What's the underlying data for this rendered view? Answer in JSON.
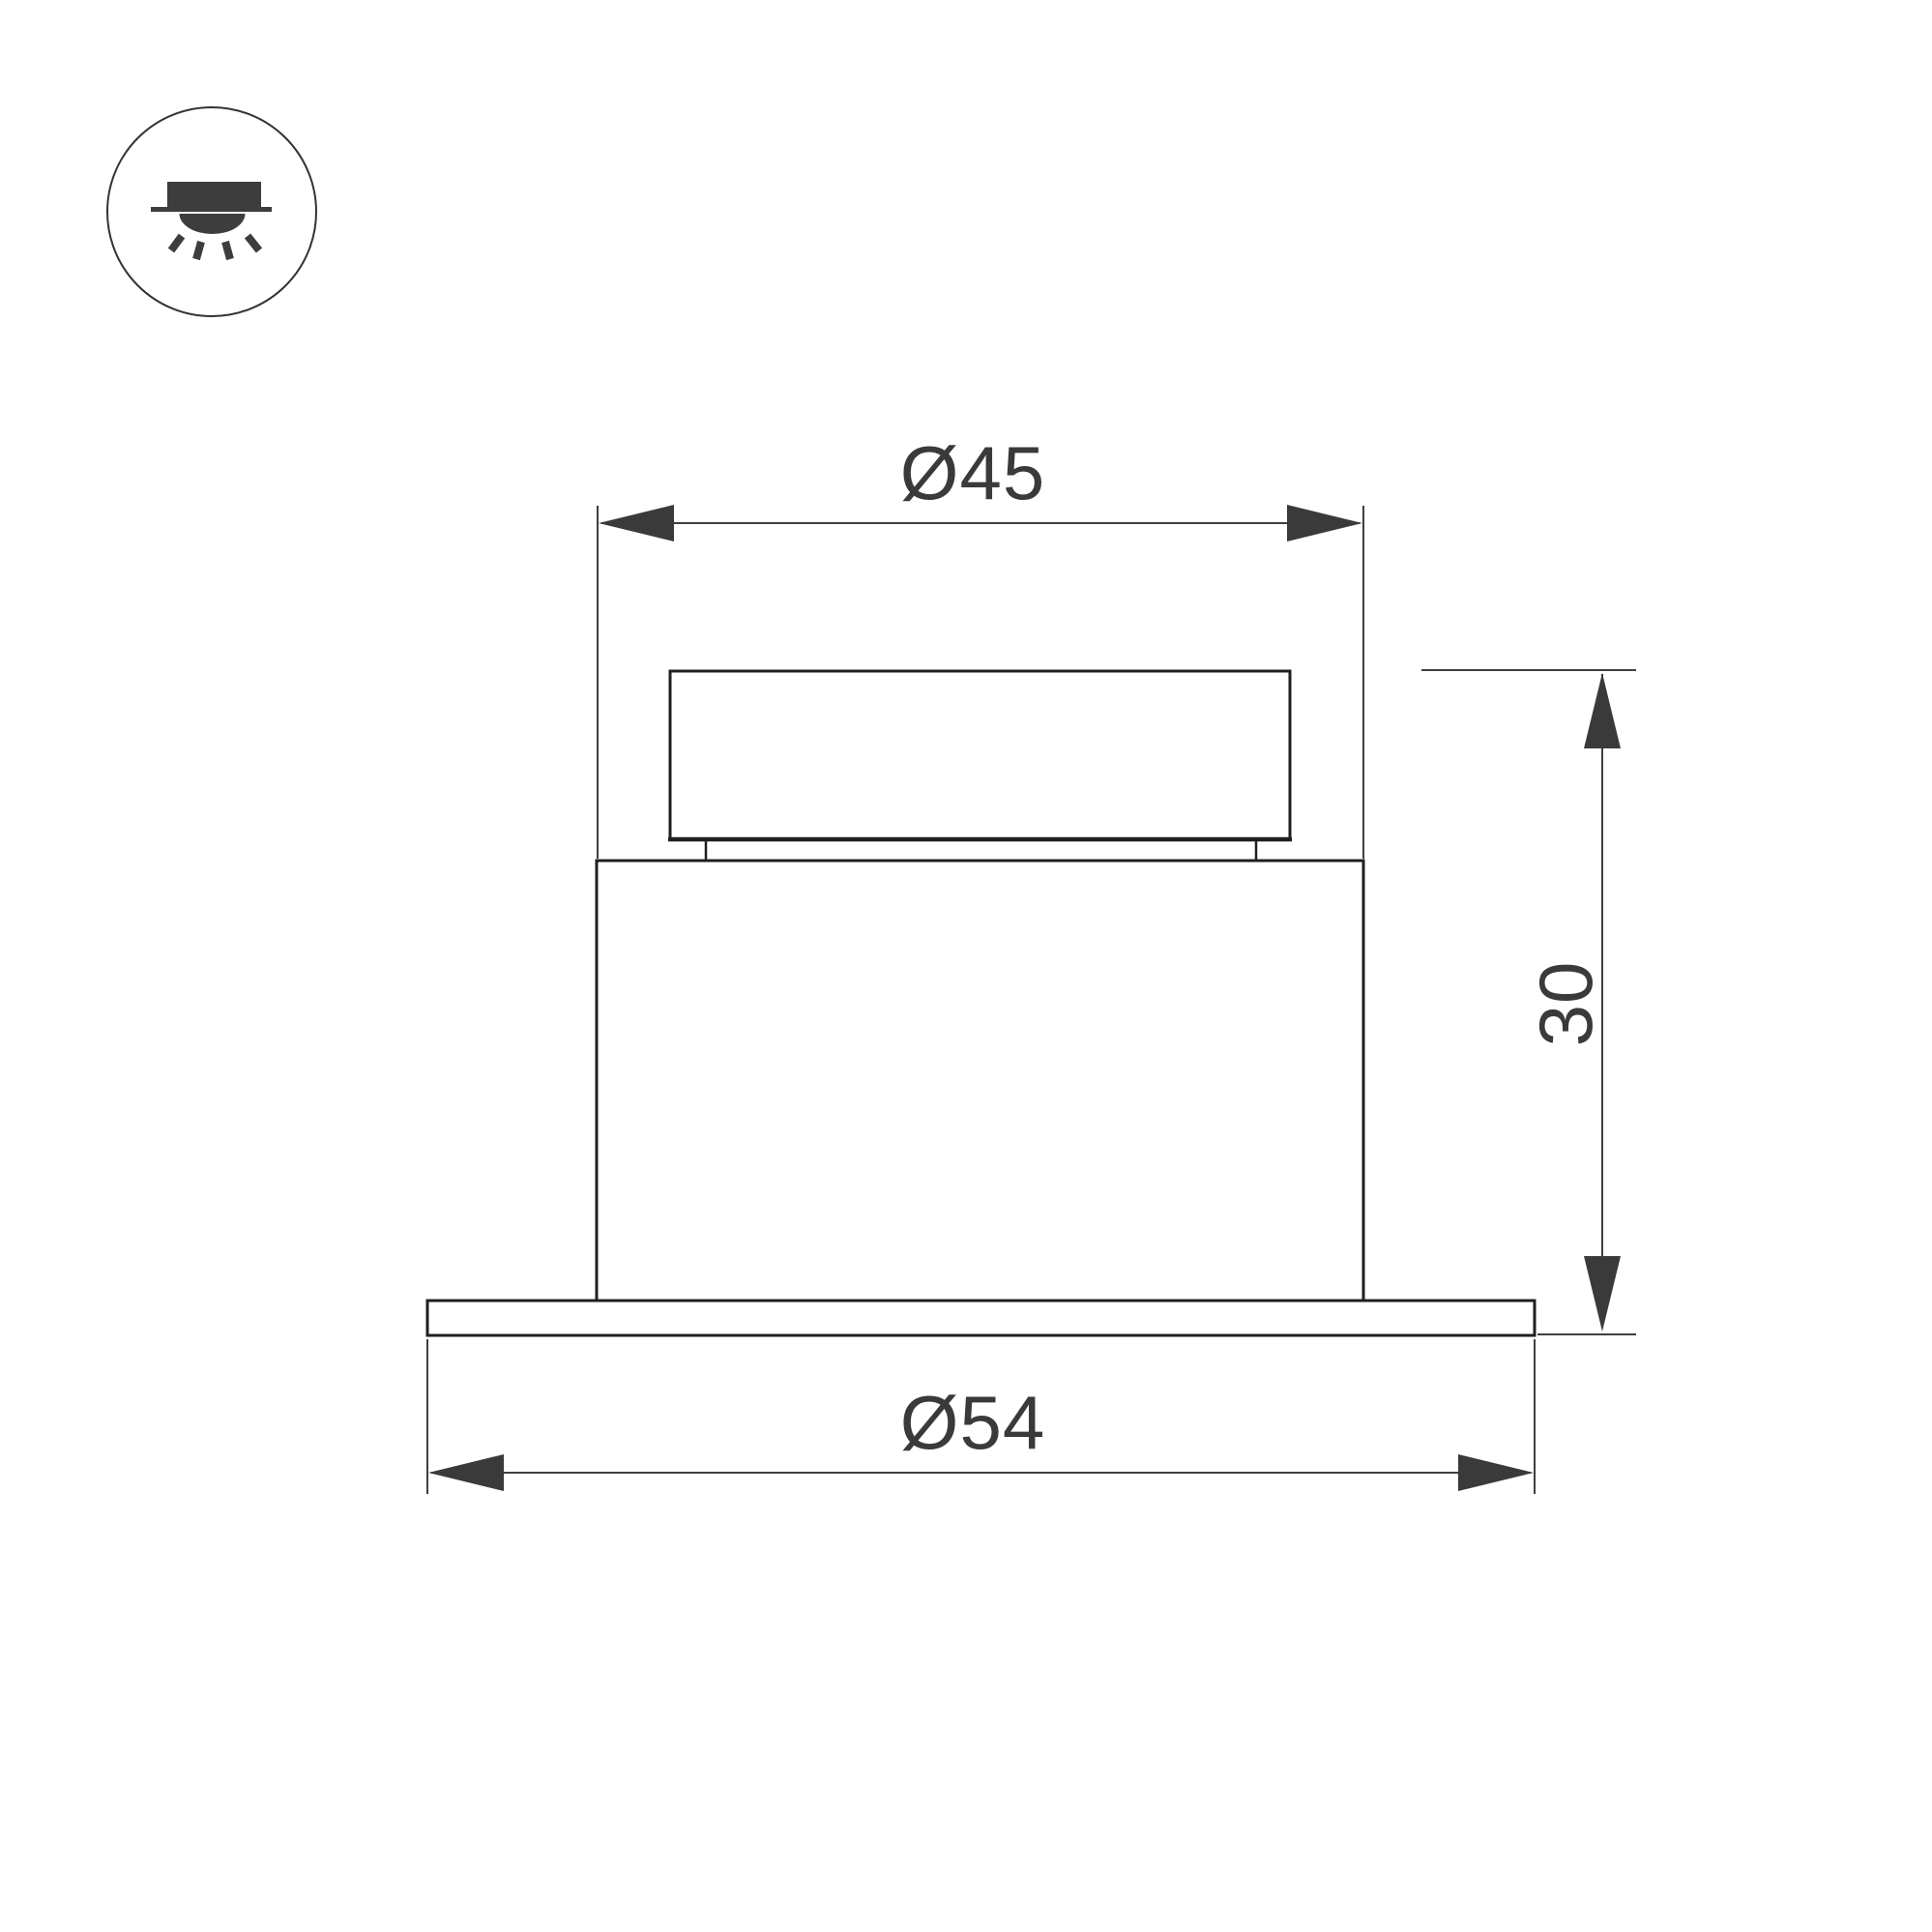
{
  "icon": {
    "name": "recessed-downlight-mounting-icon"
  },
  "dimensions": {
    "body_diameter": {
      "label": "Ø45"
    },
    "flange_diameter": {
      "label": "Ø54"
    },
    "height": {
      "label": "30"
    }
  },
  "colors": {
    "background": "#ffffff",
    "outline": "#1f1f1f",
    "thin_line": "#3f3f3f",
    "dimension_text": "#3a3a3a",
    "icon_glyph": "#3d3d3d"
  }
}
